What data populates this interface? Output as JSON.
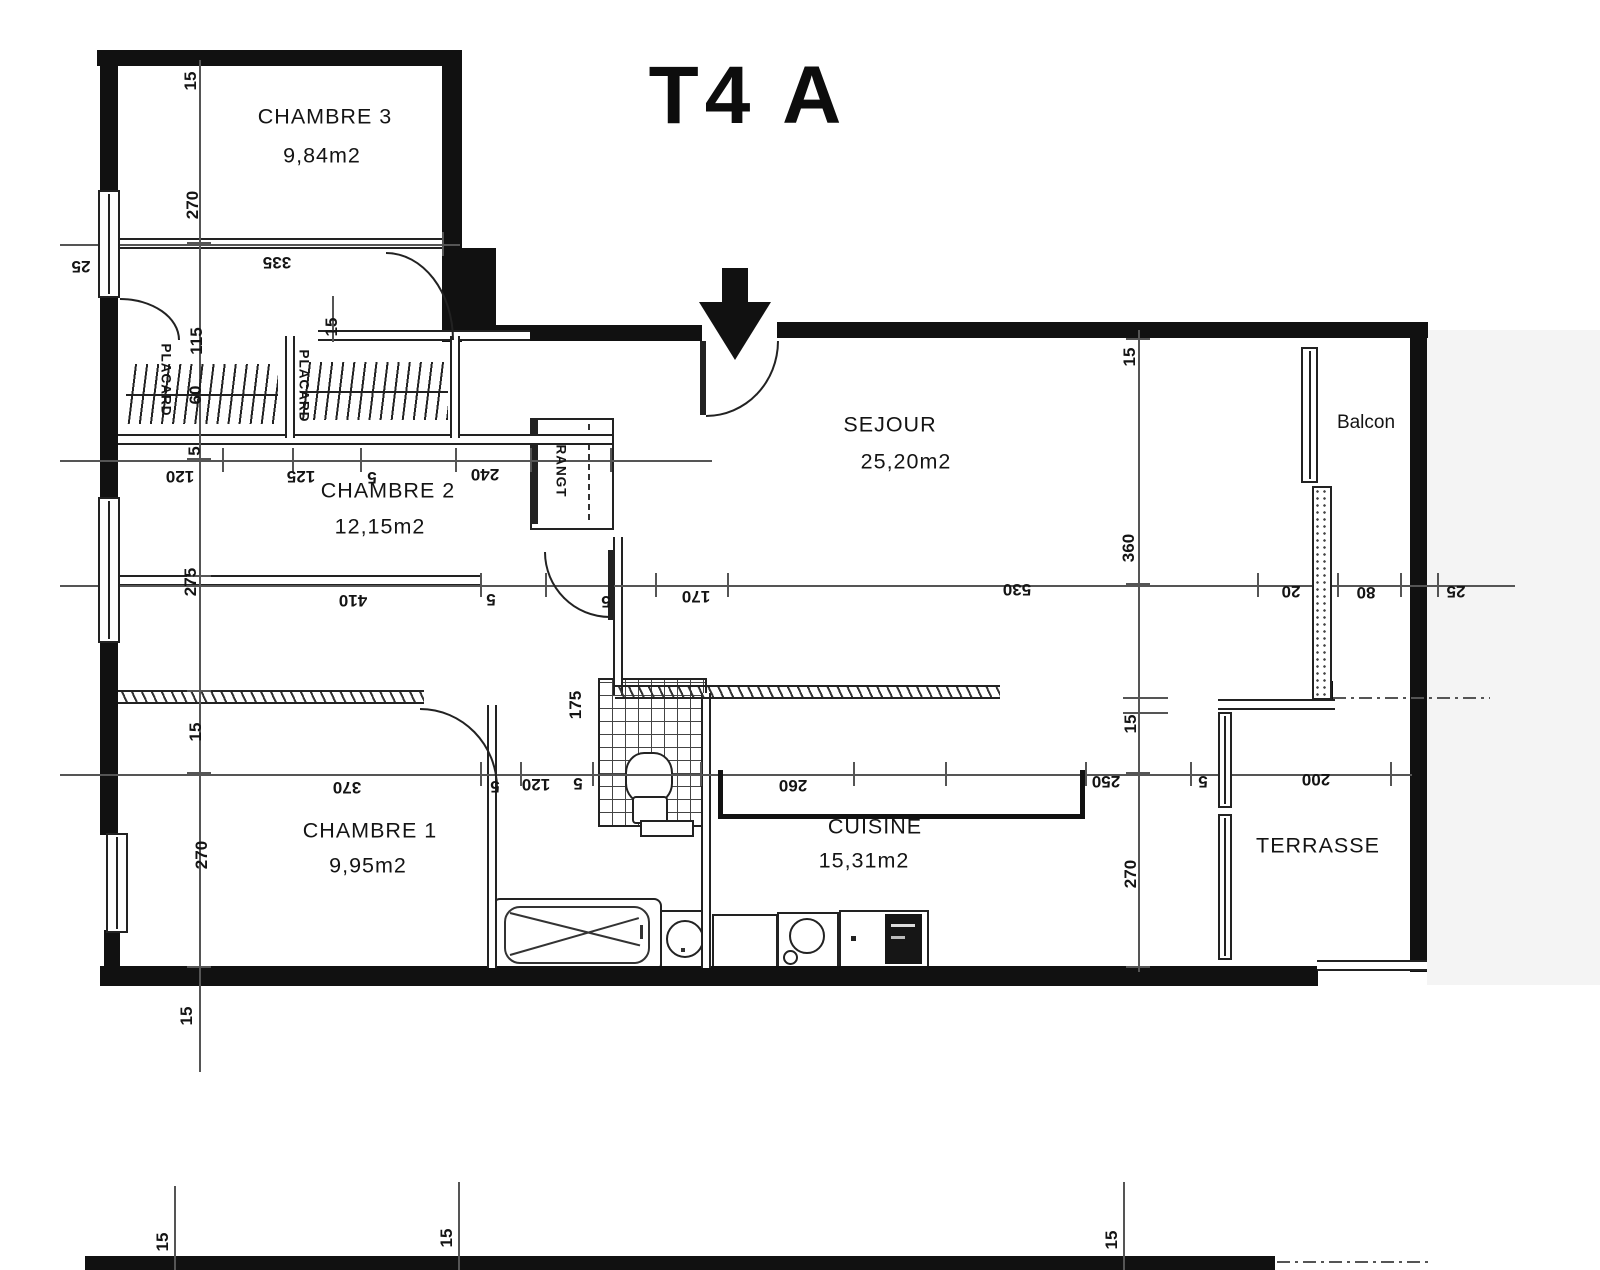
{
  "title": "T4 A",
  "plan": {
    "walls": [
      [
        97,
        50,
        362,
        16
      ],
      [
        100,
        50,
        18,
        142
      ],
      [
        100,
        298,
        18,
        202
      ],
      [
        100,
        643,
        18,
        192
      ],
      [
        104,
        930,
        16,
        48
      ],
      [
        442,
        50,
        20,
        292
      ],
      [
        462,
        248,
        34,
        86
      ],
      [
        455,
        325,
        247,
        16
      ],
      [
        777,
        322,
        651,
        16
      ],
      [
        1410,
        322,
        17,
        650
      ],
      [
        100,
        966,
        1218,
        20
      ],
      [
        85,
        1256,
        1190,
        14
      ],
      [
        1313,
        681,
        20,
        20
      ]
    ],
    "thin_h": [
      [
        118,
        238,
        324
      ],
      [
        318,
        330,
        212
      ],
      [
        118,
        434,
        494
      ],
      [
        118,
        575,
        362
      ],
      [
        1218,
        699,
        117
      ],
      [
        1317,
        960,
        110
      ]
    ],
    "thin_v": [
      [
        487,
        705,
        263
      ],
      [
        701,
        693,
        275
      ],
      [
        613,
        537,
        158
      ],
      [
        285,
        336,
        102
      ],
      [
        450,
        336,
        102
      ]
    ],
    "hatch_walls": [
      [
        118,
        690,
        306,
        14
      ],
      [
        615,
        685,
        385,
        14
      ]
    ],
    "dim_h_lines": [
      [
        60,
        244,
        400
      ],
      [
        60,
        460,
        652
      ],
      [
        60,
        585,
        1455
      ],
      [
        60,
        774,
        1352
      ],
      [
        1123,
        697,
        45
      ],
      [
        1123,
        712,
        45
      ]
    ],
    "dim_v_lines": [
      [
        199,
        60,
        1012
      ],
      [
        1138,
        330,
        642
      ],
      [
        332,
        296,
        46
      ],
      [
        174,
        1186,
        84
      ],
      [
        458,
        1182,
        88
      ],
      [
        1123,
        1182,
        88
      ]
    ],
    "ticks_v": [
      [
        118,
        232
      ],
      [
        442,
        232
      ],
      [
        222,
        448
      ],
      [
        292,
        448
      ],
      [
        360,
        448
      ],
      [
        455,
        448
      ],
      [
        530,
        448
      ],
      [
        610,
        448
      ],
      [
        480,
        573
      ],
      [
        545,
        573
      ],
      [
        655,
        573
      ],
      [
        727,
        573
      ],
      [
        1257,
        573
      ],
      [
        1337,
        573
      ],
      [
        1400,
        573
      ],
      [
        1437,
        573
      ],
      [
        480,
        762
      ],
      [
        520,
        762
      ],
      [
        592,
        762
      ],
      [
        700,
        762
      ],
      [
        853,
        762
      ],
      [
        945,
        762
      ],
      [
        1085,
        762
      ],
      [
        1190,
        762
      ],
      [
        1390,
        762
      ]
    ],
    "ticks_h": [
      [
        187,
        242
      ],
      [
        187,
        458
      ],
      [
        187,
        575
      ],
      [
        187,
        690
      ],
      [
        187,
        772
      ],
      [
        187,
        966
      ],
      [
        1126,
        338
      ],
      [
        1126,
        583
      ],
      [
        1126,
        772
      ],
      [
        1126,
        966
      ]
    ],
    "dashdot": [
      [
        1333,
        697,
        157
      ],
      [
        1277,
        1261,
        153
      ]
    ],
    "windows": [
      [
        98,
        190,
        22,
        108
      ],
      [
        98,
        497,
        22,
        146
      ],
      [
        106,
        833,
        22,
        100
      ],
      [
        1301,
        347,
        17,
        136
      ],
      [
        1218,
        712,
        14,
        96
      ],
      [
        1218,
        814,
        14,
        146
      ]
    ],
    "stipple_piers": [
      [
        1312,
        486,
        20,
        214
      ]
    ],
    "doors": [
      {
        "x": 706,
        "y": 341,
        "w": 71,
        "h": 74,
        "corner": "br"
      },
      {
        "x": 386,
        "y": 252,
        "w": 66,
        "h": 86,
        "corner": "tr"
      },
      {
        "x": 544,
        "y": 552,
        "w": 64,
        "h": 64,
        "corner": "bl"
      },
      {
        "x": 420,
        "y": 708,
        "w": 76,
        "h": 78,
        "corner": "tr"
      },
      {
        "x": 120,
        "y": 298,
        "w": 58,
        "h": 40,
        "corner": "tr"
      }
    ],
    "leaves": [
      [
        700,
        341,
        6,
        74
      ],
      [
        608,
        550,
        6,
        70
      ]
    ],
    "closet_hatches": [
      [
        126,
        364,
        152,
        60
      ],
      [
        300,
        362,
        148,
        58
      ]
    ],
    "counter_bracket": {
      "left": [
        718,
        770,
        5,
        48
      ],
      "bottom": [
        718,
        814,
        367,
        5
      ],
      "right": [
        1080,
        770,
        5,
        48
      ]
    },
    "shades": [
      [
        1427,
        330,
        173,
        655
      ]
    ],
    "labels": [
      {
        "t": "CHAMBRE 3",
        "x": 325,
        "y": 117,
        "c": "room"
      },
      {
        "t": "9,84m2",
        "x": 322,
        "y": 156,
        "c": "room"
      },
      {
        "t": "CHAMBRE 2",
        "x": 388,
        "y": 491,
        "c": "room"
      },
      {
        "t": "12,15m2",
        "x": 380,
        "y": 527,
        "c": "room"
      },
      {
        "t": "SEJOUR",
        "x": 890,
        "y": 425,
        "c": "room"
      },
      {
        "t": "25,20m2",
        "x": 906,
        "y": 462,
        "c": "room"
      },
      {
        "t": "Balcon",
        "x": 1366,
        "y": 423,
        "c": "balcon"
      },
      {
        "t": "CHAMBRE 1",
        "x": 370,
        "y": 831,
        "c": "room"
      },
      {
        "t": "9,95m2",
        "x": 368,
        "y": 866,
        "c": "room"
      },
      {
        "t": "CUISINE",
        "x": 875,
        "y": 827,
        "c": "room"
      },
      {
        "t": "15,31m2",
        "x": 864,
        "y": 861,
        "c": "room"
      },
      {
        "t": "TERRASSE",
        "x": 1318,
        "y": 846,
        "c": "room"
      },
      {
        "t": "335",
        "x": 277,
        "y": 262,
        "c": "dim180"
      },
      {
        "t": "25",
        "x": 81,
        "y": 266,
        "c": "dim180"
      },
      {
        "t": "120",
        "x": 180,
        "y": 476,
        "c": "dim180"
      },
      {
        "t": "125",
        "x": 301,
        "y": 476,
        "c": "dim180"
      },
      {
        "t": "5",
        "x": 372,
        "y": 477,
        "c": "dim180"
      },
      {
        "t": "240",
        "x": 485,
        "y": 474,
        "c": "dim180"
      },
      {
        "t": "410",
        "x": 353,
        "y": 600,
        "c": "dim180"
      },
      {
        "t": "5",
        "x": 491,
        "y": 599,
        "c": "dim180"
      },
      {
        "t": "5",
        "x": 606,
        "y": 601,
        "c": "dim180"
      },
      {
        "t": "170",
        "x": 696,
        "y": 596,
        "c": "dim180"
      },
      {
        "t": "530",
        "x": 1017,
        "y": 589,
        "c": "dim180"
      },
      {
        "t": "20",
        "x": 1291,
        "y": 591,
        "c": "dim180"
      },
      {
        "t": "80",
        "x": 1366,
        "y": 592,
        "c": "dim180"
      },
      {
        "t": "25",
        "x": 1456,
        "y": 591,
        "c": "dim180"
      },
      {
        "t": "370",
        "x": 347,
        "y": 787,
        "c": "dim180"
      },
      {
        "t": "5",
        "x": 495,
        "y": 786,
        "c": "dim180"
      },
      {
        "t": "120",
        "x": 536,
        "y": 784,
        "c": "dim180"
      },
      {
        "t": "5",
        "x": 578,
        "y": 783,
        "c": "dim180"
      },
      {
        "t": "260",
        "x": 793,
        "y": 785,
        "c": "dim180"
      },
      {
        "t": "250",
        "x": 1106,
        "y": 781,
        "c": "dim180"
      },
      {
        "t": "5",
        "x": 1203,
        "y": 781,
        "c": "dim180"
      },
      {
        "t": "200",
        "x": 1316,
        "y": 779,
        "c": "dim180"
      },
      {
        "t": "15",
        "x": 191,
        "y": 81,
        "c": "dimv"
      },
      {
        "t": "270",
        "x": 193,
        "y": 205,
        "c": "dimv"
      },
      {
        "t": "115",
        "x": 197,
        "y": 341,
        "c": "dimv"
      },
      {
        "t": "60",
        "x": 196,
        "y": 395,
        "c": "dimv"
      },
      {
        "t": "5",
        "x": 195,
        "y": 451,
        "c": "dimv"
      },
      {
        "t": "275",
        "x": 191,
        "y": 582,
        "c": "dimv"
      },
      {
        "t": "15",
        "x": 332,
        "y": 327,
        "c": "dimv"
      },
      {
        "t": "15",
        "x": 196,
        "y": 732,
        "c": "dimv"
      },
      {
        "t": "270",
        "x": 202,
        "y": 855,
        "c": "dimv"
      },
      {
        "t": "15",
        "x": 187,
        "y": 1016,
        "c": "dimv"
      },
      {
        "t": "15",
        "x": 163,
        "y": 1242,
        "c": "dimv"
      },
      {
        "t": "15",
        "x": 447,
        "y": 1238,
        "c": "dimv"
      },
      {
        "t": "175",
        "x": 576,
        "y": 705,
        "c": "dimv"
      },
      {
        "t": "15",
        "x": 1130,
        "y": 357,
        "c": "dimv"
      },
      {
        "t": "360",
        "x": 1129,
        "y": 548,
        "c": "dimv"
      },
      {
        "t": "15",
        "x": 1131,
        "y": 724,
        "c": "dimv"
      },
      {
        "t": "270",
        "x": 1131,
        "y": 874,
        "c": "dimv"
      },
      {
        "t": "15",
        "x": 1112,
        "y": 1240,
        "c": "dimv"
      },
      {
        "t": "PLACARD",
        "x": 166,
        "y": 380,
        "c": "closet"
      },
      {
        "t": "PLACARD",
        "x": 304,
        "y": 386,
        "c": "closet"
      },
      {
        "t": "RANGT",
        "x": 561,
        "y": 471,
        "c": "closet"
      }
    ]
  }
}
